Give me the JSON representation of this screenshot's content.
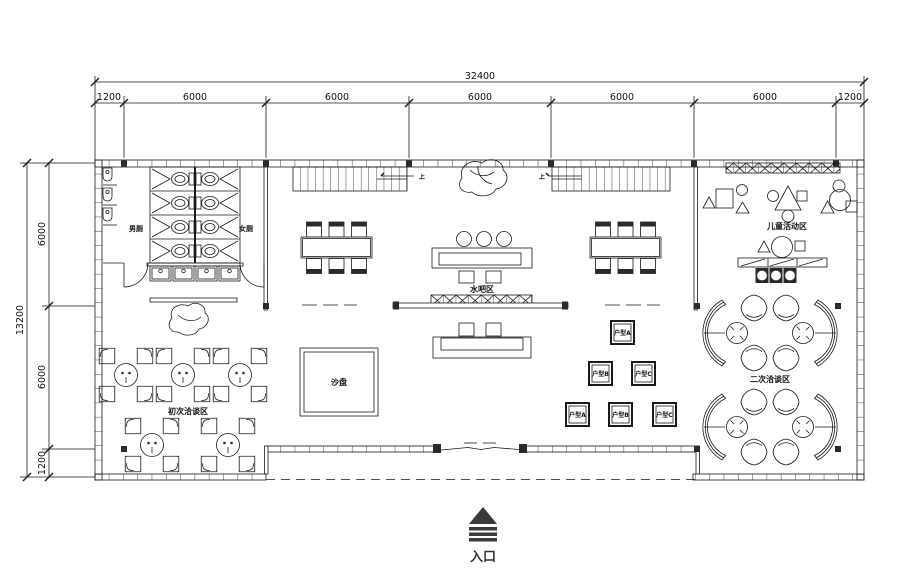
{
  "dimensions": {
    "top": {
      "total": "32400",
      "segments": [
        "1200",
        "6000",
        "6000",
        "6000",
        "6000",
        "6000",
        "1200"
      ]
    },
    "left": {
      "total": "13200",
      "segments": [
        "6000",
        "6000",
        "1200"
      ]
    }
  },
  "rooms": {
    "mens_toilet": "男厕",
    "womens_toilet": "女厕",
    "water_bar": "水吧区",
    "sand_table": "沙盘",
    "initial_negotiation": "初次洽谈区",
    "second_negotiation": "二次洽谈区",
    "children_activity": "儿童活动区"
  },
  "unit_boards": {
    "row1": [
      "户型A"
    ],
    "row2": [
      "户型B",
      "户型C"
    ],
    "row3": [
      "户型A",
      "户型B",
      "户型C"
    ]
  },
  "stairs": {
    "up_label": "上"
  },
  "entrance": {
    "label": "入口"
  },
  "colors": {
    "line": "#1a1a1a",
    "background": "#ffffff",
    "marker": "#3a3a3a"
  }
}
